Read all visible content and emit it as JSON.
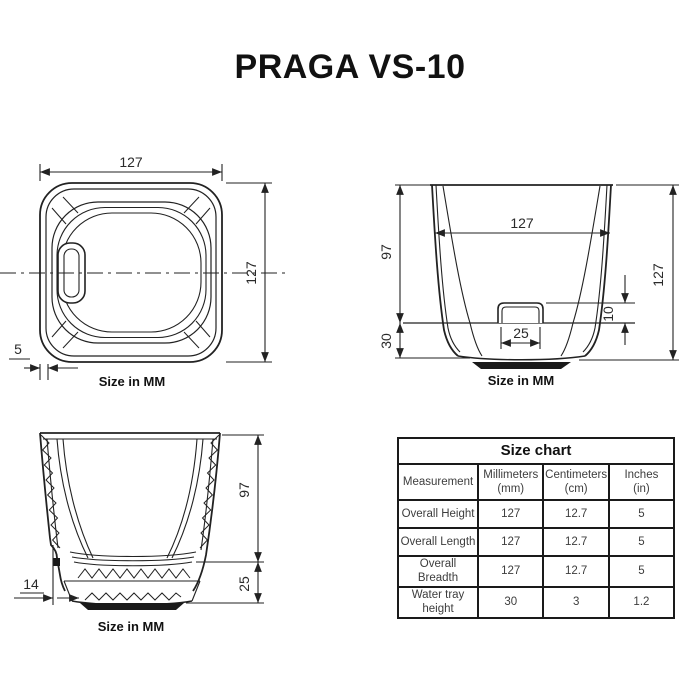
{
  "title": "PRAGA VS-10",
  "views": {
    "top": {
      "caption": "Size in MM",
      "width": "127",
      "height": "127",
      "wall": "5"
    },
    "side": {
      "caption": "Size in MM",
      "inner_width": "127",
      "upper_height": "97",
      "tray_height": "30",
      "overall_height": "127",
      "window_width": "25",
      "window_height": "10"
    },
    "section": {
      "caption": "Size in MM",
      "inner_height": "97",
      "base_height": "25",
      "step_width": "14"
    }
  },
  "size_chart": {
    "title": "Size chart",
    "columns": {
      "measurement": "Measurement",
      "mm_line1": "Millimeters",
      "mm_line2": "(mm)",
      "cm_line1": "Centimeters",
      "cm_line2": "(cm)",
      "in_line1": "Inches",
      "in_line2": "(in)"
    },
    "rows": [
      {
        "label": "Overall Height",
        "mm": "127",
        "cm": "12.7",
        "in": "5"
      },
      {
        "label": "Overall Length",
        "mm": "127",
        "cm": "12.7",
        "in": "5"
      },
      {
        "label": "Overall Breadth",
        "mm": "127",
        "cm": "12.7",
        "in": "5"
      },
      {
        "label": "Water tray height",
        "mm": "30",
        "cm": "3",
        "in": "1.2"
      }
    ]
  },
  "colors": {
    "line": "#222222",
    "text": "#2a2a2a"
  }
}
